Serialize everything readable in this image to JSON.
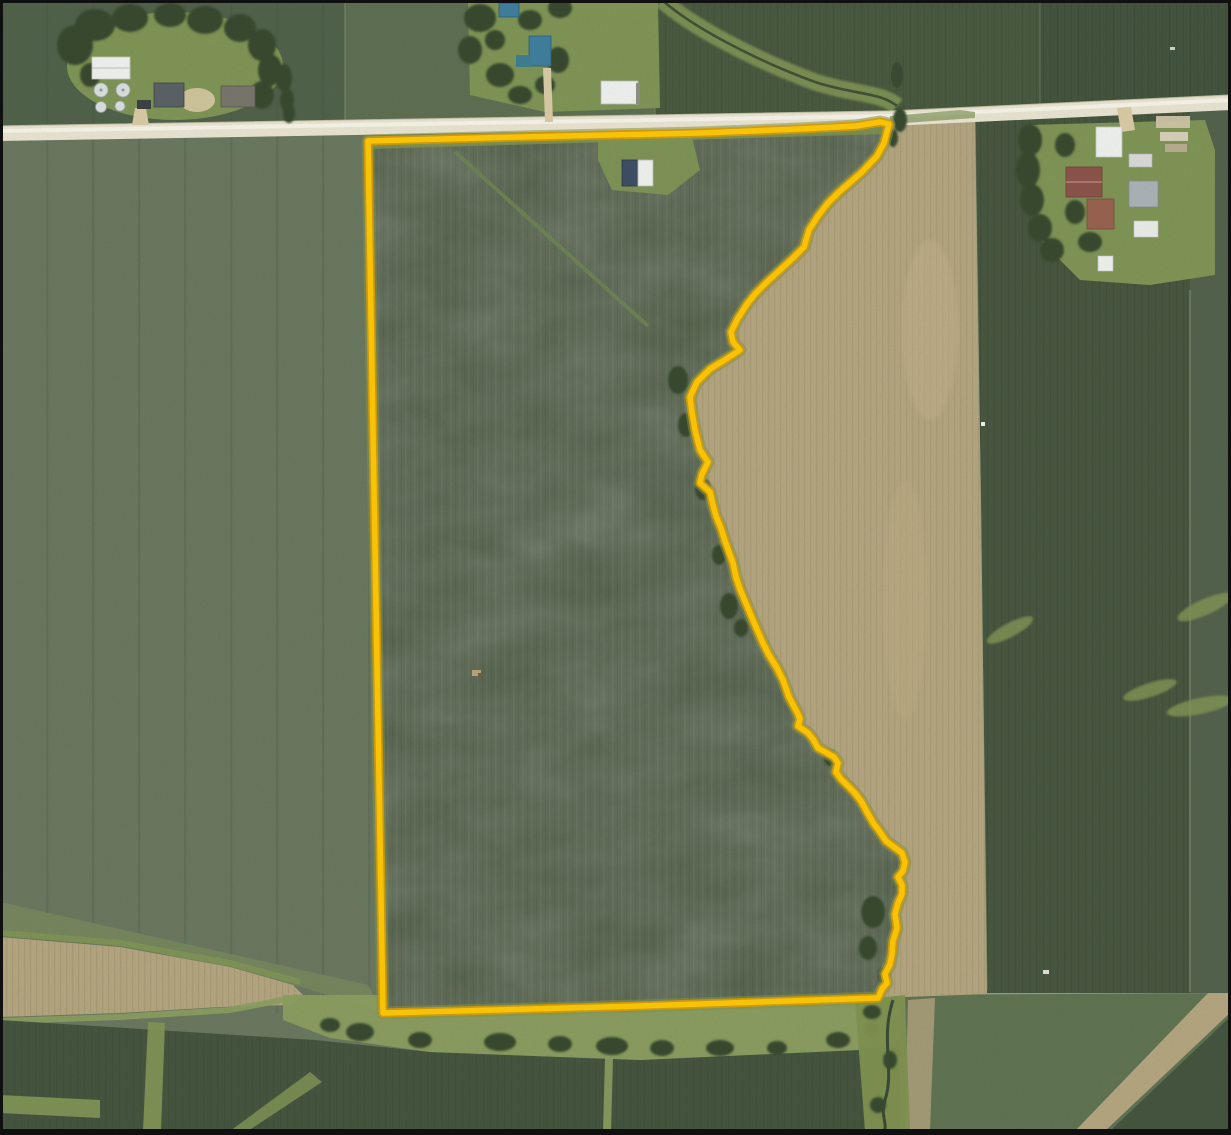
{
  "page": {
    "title": "Aerial parcel map",
    "kind": "aerial-imagery-with-parcel-outline"
  },
  "map": {
    "parcel": {
      "outline_color": "#F8C306",
      "boundary_px": [
        [
          368,
          141
        ],
        [
          520,
          137
        ],
        [
          700,
          133
        ],
        [
          800,
          129
        ],
        [
          856,
          126
        ],
        [
          880,
          122
        ],
        [
          889,
          124
        ],
        [
          884,
          143
        ],
        [
          877,
          156
        ],
        [
          862,
          172
        ],
        [
          854,
          179
        ],
        [
          838,
          193
        ],
        [
          828,
          203
        ],
        [
          818,
          216
        ],
        [
          809,
          230
        ],
        [
          804,
          247
        ],
        [
          793,
          258
        ],
        [
          780,
          270
        ],
        [
          768,
          281
        ],
        [
          755,
          294
        ],
        [
          747,
          304
        ],
        [
          738,
          318
        ],
        [
          731,
          332
        ],
        [
          733,
          342
        ],
        [
          740,
          350
        ],
        [
          723,
          361
        ],
        [
          710,
          369
        ],
        [
          697,
          382
        ],
        [
          690,
          397
        ],
        [
          692,
          412
        ],
        [
          695,
          430
        ],
        [
          700,
          450
        ],
        [
          708,
          462
        ],
        [
          702,
          474
        ],
        [
          700,
          483
        ],
        [
          710,
          492
        ],
        [
          713,
          505
        ],
        [
          716,
          516
        ],
        [
          721,
          528
        ],
        [
          725,
          541
        ],
        [
          729,
          552
        ],
        [
          733,
          563
        ],
        [
          736,
          577
        ],
        [
          740,
          589
        ],
        [
          745,
          601
        ],
        [
          750,
          613
        ],
        [
          756,
          627
        ],
        [
          763,
          643
        ],
        [
          769,
          655
        ],
        [
          777,
          668
        ],
        [
          783,
          680
        ],
        [
          789,
          697
        ],
        [
          797,
          712
        ],
        [
          800,
          719
        ],
        [
          798,
          726
        ],
        [
          808,
          733
        ],
        [
          813,
          739
        ],
        [
          818,
          748
        ],
        [
          827,
          753
        ],
        [
          834,
          757
        ],
        [
          838,
          763
        ],
        [
          836,
          772
        ],
        [
          841,
          779
        ],
        [
          848,
          786
        ],
        [
          854,
          792
        ],
        [
          861,
          801
        ],
        [
          867,
          812
        ],
        [
          874,
          824
        ],
        [
          880,
          832
        ],
        [
          886,
          841
        ],
        [
          894,
          847
        ],
        [
          902,
          853
        ],
        [
          905,
          862
        ],
        [
          903,
          871
        ],
        [
          898,
          877
        ],
        [
          902,
          885
        ],
        [
          902,
          894
        ],
        [
          898,
          903
        ],
        [
          895,
          914
        ],
        [
          897,
          928
        ],
        [
          893,
          941
        ],
        [
          892,
          954
        ],
        [
          890,
          964
        ],
        [
          885,
          974
        ],
        [
          887,
          983
        ],
        [
          882,
          989
        ],
        [
          878,
          998
        ],
        [
          640,
          1006
        ],
        [
          383,
          1013
        ]
      ],
      "tan_field_east_edge_px": [
        [
          893,
          124
        ],
        [
          975,
          120
        ],
        [
          981,
          500
        ],
        [
          987,
          990
        ],
        [
          987,
          994
        ]
      ]
    },
    "features": [
      "county-road-north",
      "creek-treeline-east-boundary",
      "row-crop-field-inside-parcel",
      "bare-fallow-field-east",
      "grass-waterway-south",
      "farmstead-northwest",
      "farmstead-north-center",
      "farmstead-east"
    ],
    "colors": {
      "frame": "#101010",
      "road": "#E7E2D0",
      "road-line": "#F5F3E8",
      "field-west": "#69775F",
      "field-parcel": "#54624B",
      "field-tan": "#B2A47E",
      "field-dark": "#47563F",
      "field-east": "#52614B",
      "north-a": "#50614A",
      "north-b": "#5D6E52",
      "north-c": "#49593F",
      "north-d": "#43533D",
      "grass": "#7E9355",
      "grass-bright": "#8B9D5F",
      "headland": "#75865D",
      "trees": "#39482F",
      "creek": "#3A4A33",
      "bottom-dark": "#45543E",
      "bottom-right": "#5F7251",
      "bldg-white": "#EDEFEC",
      "bldg-gray": "#A8B2B4",
      "bin": "#D8DDDD",
      "barn-red": "#8B5349",
      "house-red": "#97614F",
      "roof-blue": "#407E9D",
      "roof-teal": "#3F7D8E",
      "gravel": "#D7C9A3",
      "junk": "#CFC3A5",
      "tan-fringe": "#A89C79",
      "boundary-line": "#F8C306",
      "boundary-edge": "#D49A05",
      "margin-grass": "#7F9150"
    }
  }
}
